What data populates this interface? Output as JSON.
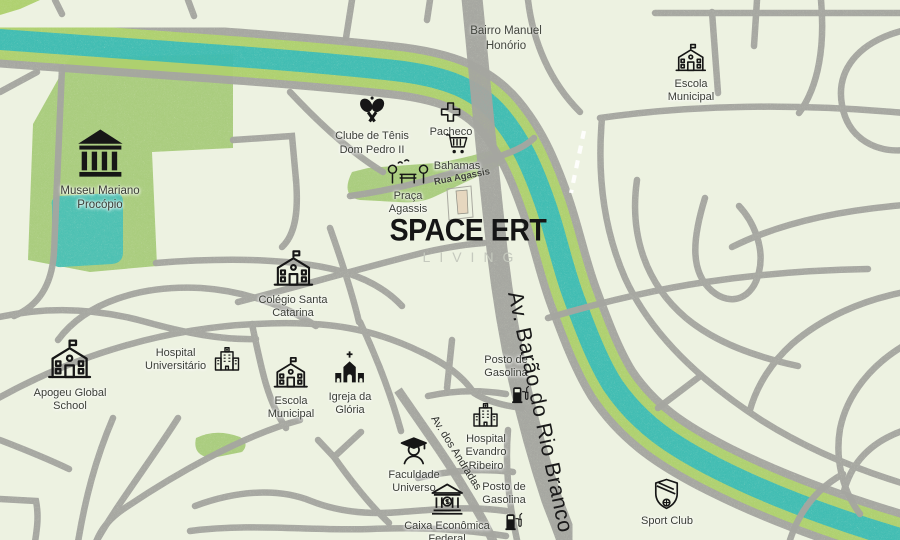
{
  "logo": {
    "title": "SPACE ERT",
    "subtitle": "LIVING"
  },
  "district_label": "Bairro Manuel\nHonório",
  "streets": {
    "rua_agassis": "Rua Agassis",
    "av_andradas": "Av. dos Andradas",
    "av_barao": "Av. Barão do Rio Branco"
  },
  "pois": {
    "museu": {
      "label": "Museu Mariano\nProcópio"
    },
    "escola_municipal_norte": {
      "label": "Escola\nMunicipal"
    },
    "clube_tenis": {
      "label": "Clube de Tênis\nDom Pedro II"
    },
    "pacheco": {
      "label": "Pacheco"
    },
    "bahamas": {
      "label": "Bahamas"
    },
    "praca_agassis": {
      "label": "Praça\nAgassis"
    },
    "colegio_santa_catarina": {
      "label": "Colégio Santa\nCatarina"
    },
    "apogeu": {
      "label": "Apogeu Global\nSchool"
    },
    "hospital_universitario": {
      "label": "Hospital\nUniversitário"
    },
    "escola_municipal_centro": {
      "label": "Escola\nMunicipal"
    },
    "igreja_gloria": {
      "label": "Igreja da\nGlória"
    },
    "posto_gasolina_norte": {
      "label": "Posto de\nGasolina"
    },
    "hospital_evandro": {
      "label": "Hospital\nEvandro\nRibeiro"
    },
    "faculdade_universo": {
      "label": "Faculdade\nUniverso"
    },
    "caixa": {
      "label": "Caixa Econômica\nFederal"
    },
    "posto_gasolina_sul": {
      "label": "Posto de\nGasolina"
    },
    "sport_club": {
      "label": "Sport Club"
    }
  },
  "colors": {
    "background": "#edf2e1",
    "river_water": "#3fbcb2",
    "river_bank": "#aed06e",
    "road": "#a5a6a0",
    "park": "#a9cc7d",
    "lake": "#4cc0b2",
    "logo_text": "#151515",
    "logo_subtitle": "#c5c9be"
  }
}
